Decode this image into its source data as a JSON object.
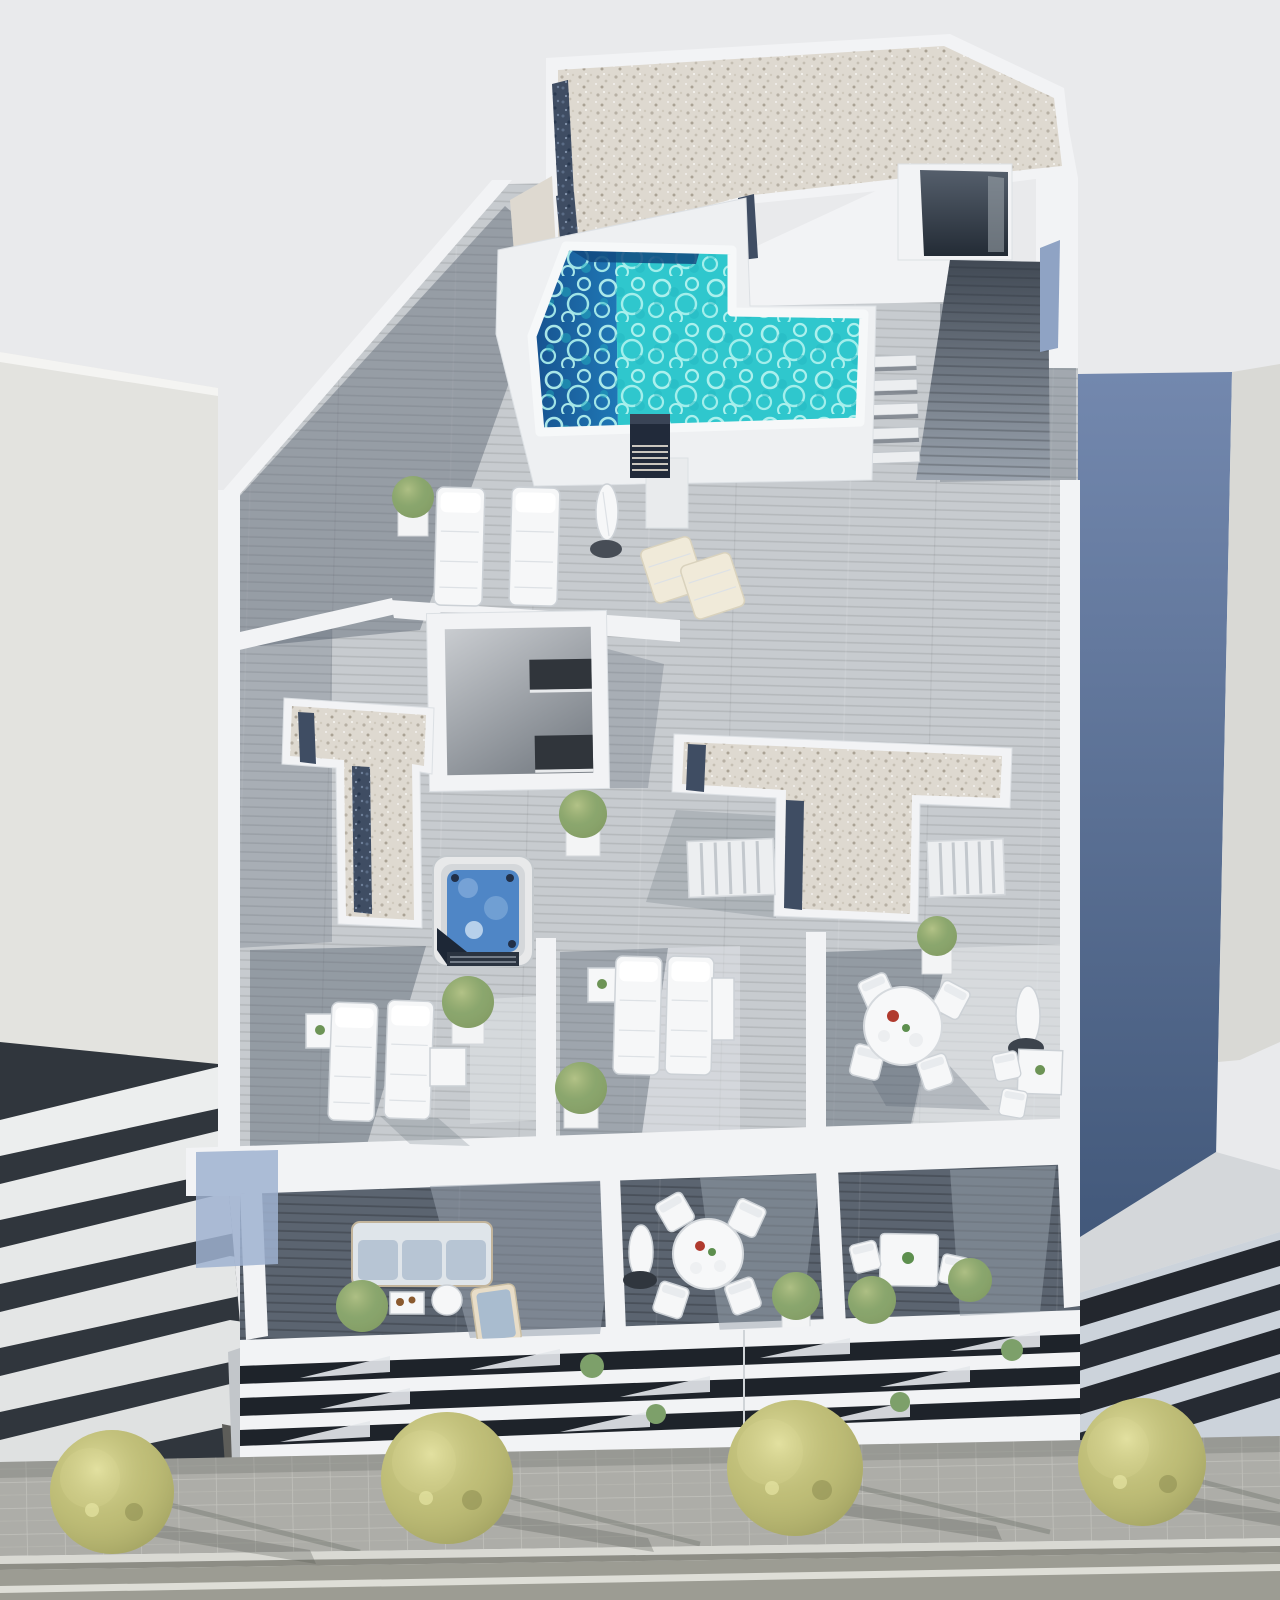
{
  "scene": {
    "image_type": "architectural 3D render, aerial top-down view",
    "description": "Modern white apartment building rooftop with L-shaped pool, gravel roof decks, jacuzzi, sun terraces and balconies; street with trees below; neighboring buildings left and right",
    "objects": [
      "L-shaped turquoise rooftop swimming pool with dark deep end and corner steps",
      "speckled gravel flat roof with dark blue gravel drainage strips",
      "roof stair head with dark lightwell opening and wood stair corridor",
      "black ventilation chimney with louvers",
      "two white cushioned sun loungers and closed parasol with round base",
      "two cream folding deck chairs",
      "central lightwell with dark windows",
      "two white gravel roof monitors (L-shaped and T-shaped) with louvered shutters",
      "square jacuzzi hot tub with blue water and dark cover",
      "lower terraces with sun loungers, side tables and potted plants",
      "round white dining table with four chairs and folded parasol",
      "square bistro tables with chairs",
      "balcony row with light-blue cushioned sofa, coffee tables, round dining set, plants",
      "slatted white facade bands with dark window openings and small plants",
      "paved sidewalk with four yellow-green trees casting long shadows",
      "asphalt road with white lane line",
      "plain light-gray neighbor building (left) with banded balconies",
      "slate-blue shaded neighbor building (right) with glass band facade"
    ]
  },
  "palette": {
    "sky": "#e9eaec",
    "white_wall": "#f2f3f5",
    "wall_shadow": "#c2c6ca",
    "neighbor_left_roof": "#e3e3df",
    "neighbor_right_roof": "#d9d9d5",
    "neighbor_right_wall_top": "#7388ae",
    "neighbor_right_wall_bottom": "#42587a",
    "deck_light": "#c7cbcf",
    "deck_mid": "#9aa3ae",
    "deck_dark": "#5b6470",
    "gravel_light": "#ded9d0",
    "gravel_blue": "#3f4d63",
    "pool_turquoise": "#2fc7cd",
    "pool_deep_left": "#1a5ca4",
    "pool_steps_dark": "#11497f",
    "jacuzzi_water": "#4f86c6",
    "vent_dark": "#212a3a",
    "foliage_green": "#7da06a",
    "tree_yellow_green": "#bcbb74",
    "sidewalk": "#adada8",
    "curb": "#d9d9d3",
    "gutter": "#8d8d85",
    "road": "#9c9c93",
    "lane_line": "#e6e6df",
    "facade_opening": "#1e232a",
    "blue_soffit": "#9fb2d0",
    "furniture_white": "#f6f7f8",
    "cushion_blue": "#b7c5d4"
  }
}
